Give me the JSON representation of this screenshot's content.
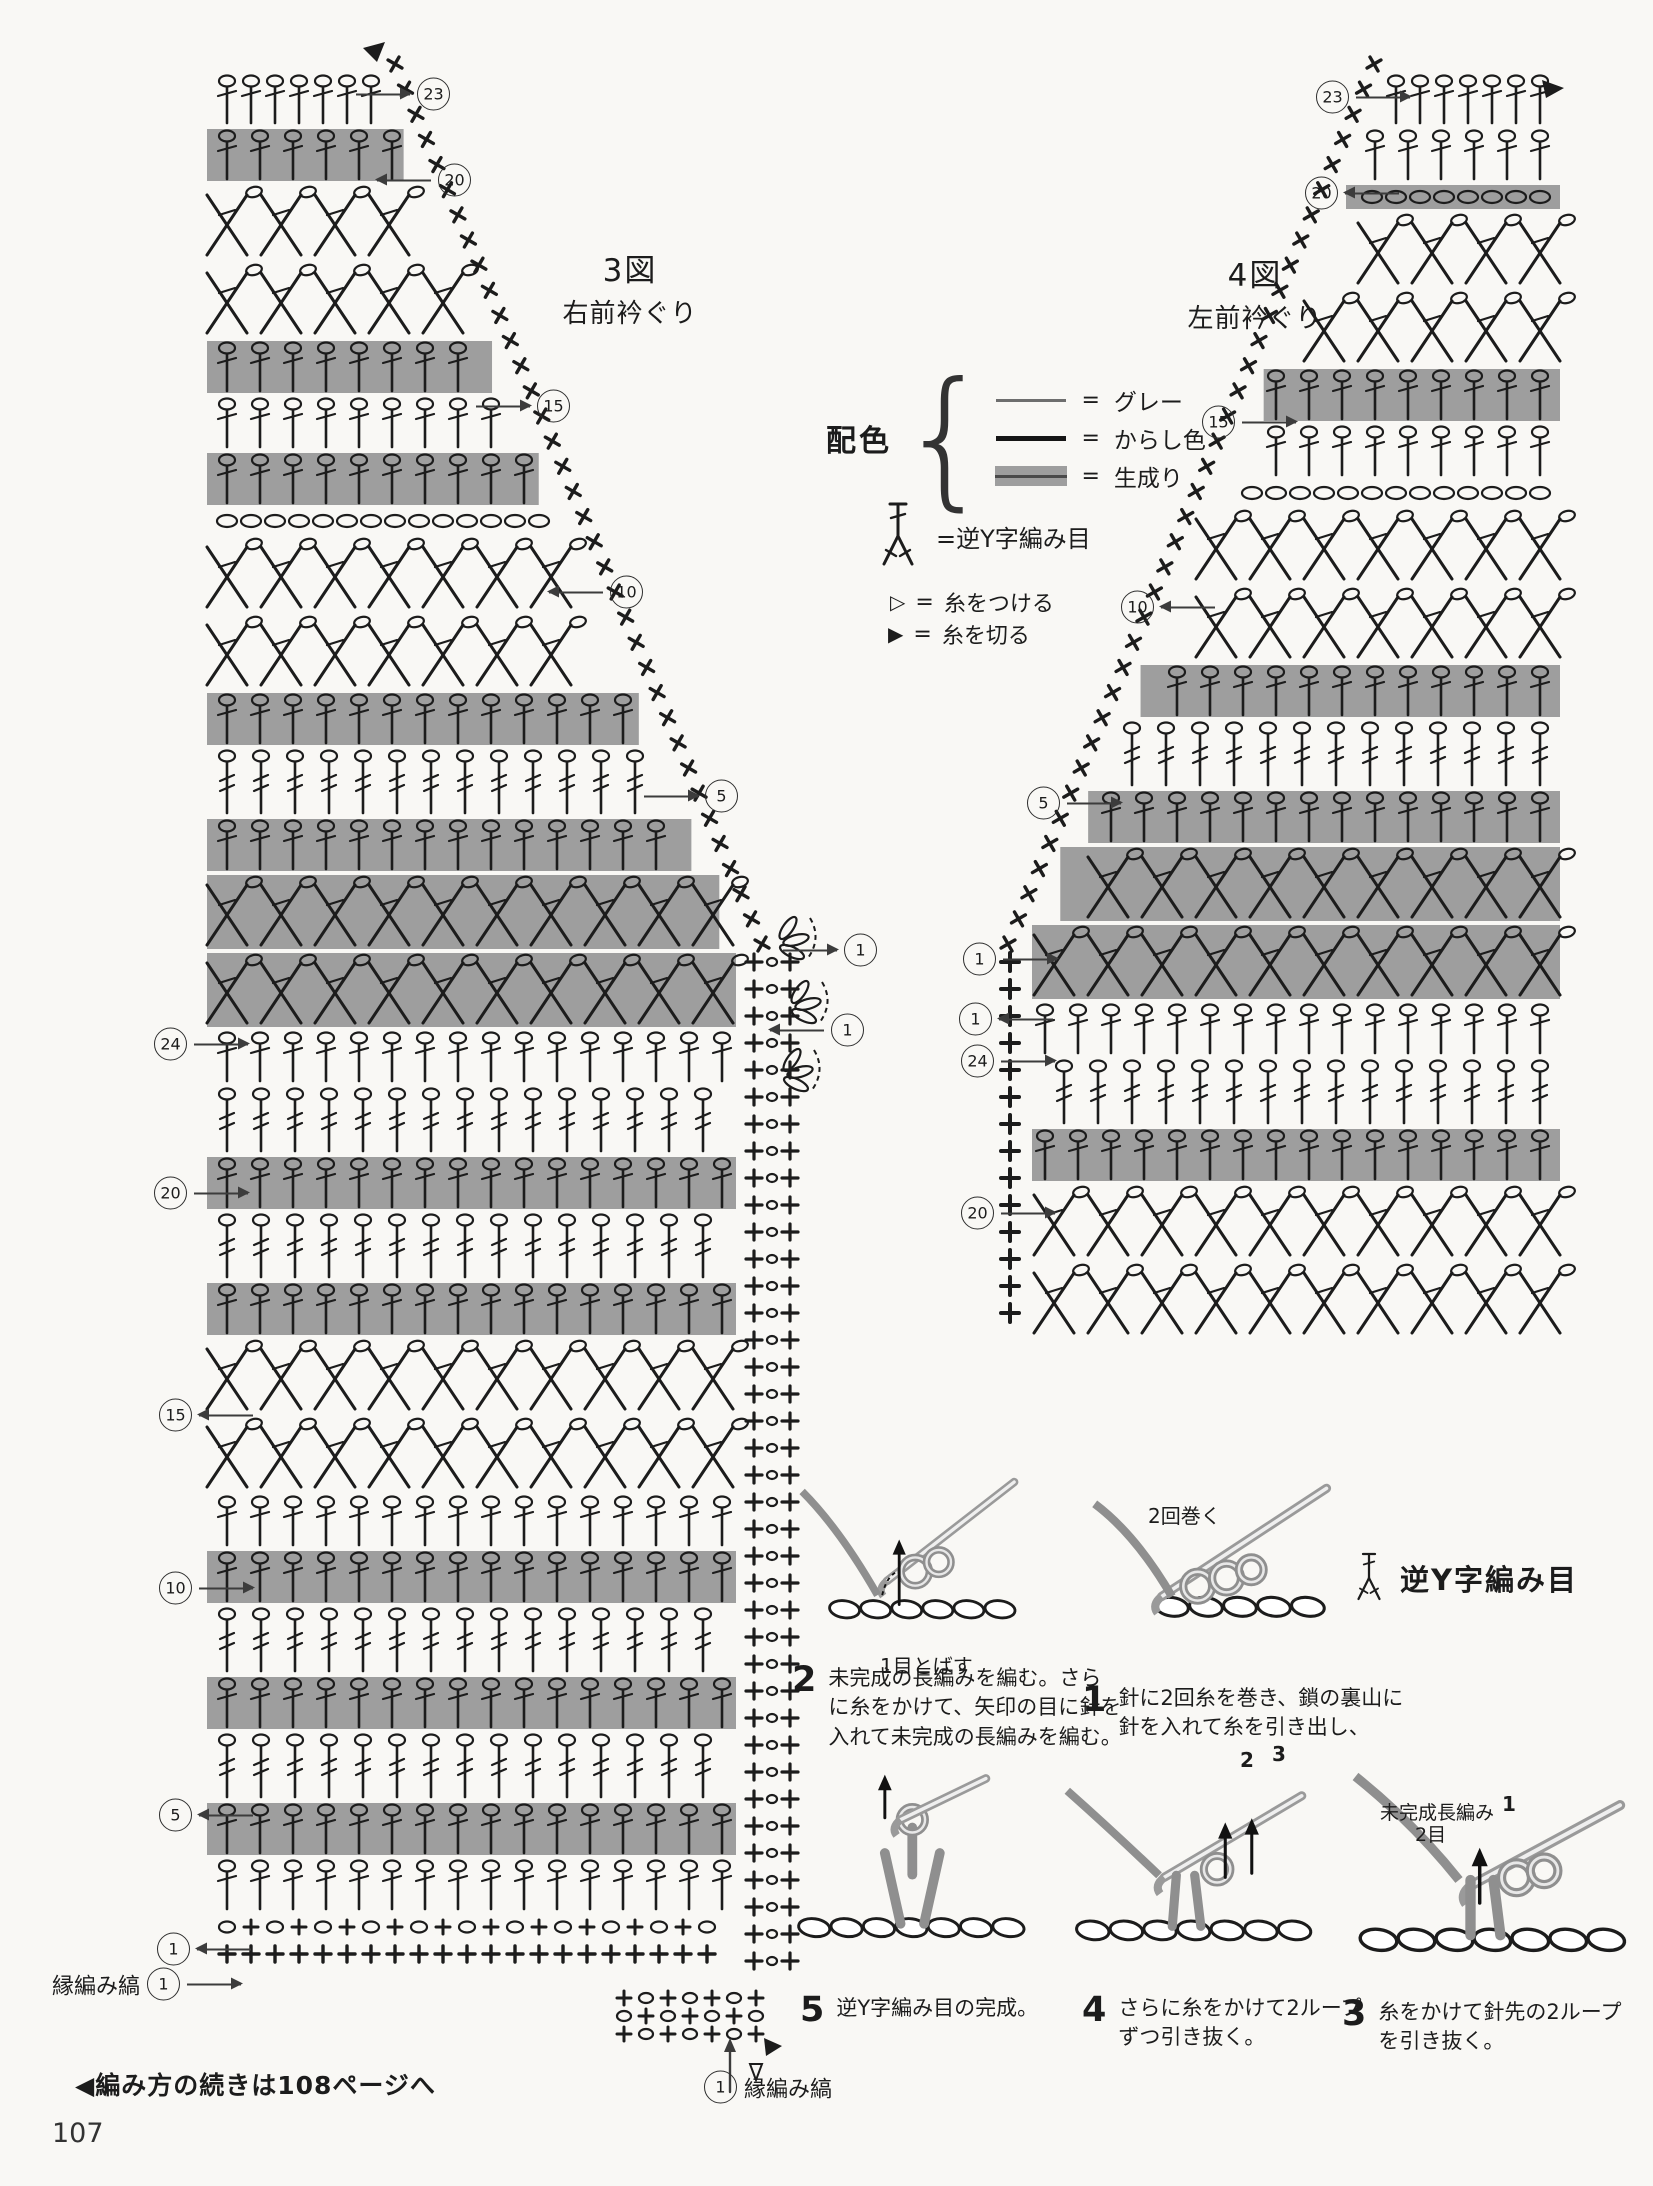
{
  "page": {
    "number": "107",
    "footer_note": "◀編み方の続きは108ページへ"
  },
  "charts": {
    "left": {
      "title": "3図",
      "subtitle": "右前衿ぐり",
      "shape": {
        "side": "right",
        "left": 65,
        "right": 592,
        "top": 32,
        "diag": {
          "x1": 225,
          "y1": 32,
          "x2": 592,
          "y2": 912
        },
        "bottom": 1927
      },
      "rows": [
        {
          "t": "Ttop"
        },
        {
          "t": "T",
          "band": true
        },
        {
          "t": "X"
        },
        {
          "t": "X"
        },
        {
          "t": "T",
          "band": true
        },
        {
          "t": "T"
        },
        {
          "t": "T",
          "band": true
        },
        {
          "t": "O"
        },
        {
          "t": "X"
        },
        {
          "t": "X"
        },
        {
          "t": "T",
          "band": true
        },
        {
          "t": "TT"
        },
        {
          "t": "T",
          "band": true
        },
        {
          "t": "X",
          "band": true
        },
        {
          "t": "X",
          "band": true
        },
        {
          "t": "T"
        },
        {
          "t": "TT"
        },
        {
          "t": "T",
          "band": true
        },
        {
          "t": "TT"
        },
        {
          "t": "T",
          "band": true
        },
        {
          "t": "X"
        },
        {
          "t": "X"
        },
        {
          "t": "T"
        },
        {
          "t": "T",
          "band": true
        },
        {
          "t": "TT"
        },
        {
          "t": "T",
          "band": true
        },
        {
          "t": "TT"
        },
        {
          "t": "T",
          "band": true
        },
        {
          "t": "T"
        },
        {
          "t": "O+"
        },
        {
          "t": "+"
        }
      ]
    },
    "right": {
      "title": "4図",
      "subtitle": "左前衿ぐり",
      "shape": {
        "side": "left",
        "left": 86,
        "right": 612,
        "top": 32,
        "diag": {
          "x1": 452,
          "y1": 32,
          "x2": 86,
          "y2": 912
        },
        "bottom": 1299
      },
      "rows": [
        {
          "t": "Ttop"
        },
        {
          "t": "T"
        },
        {
          "t": "O",
          "band": true
        },
        {
          "t": "X"
        },
        {
          "t": "X"
        },
        {
          "t": "T",
          "band": true
        },
        {
          "t": "T"
        },
        {
          "t": "O"
        },
        {
          "t": "X"
        },
        {
          "t": "X"
        },
        {
          "t": "T",
          "band": true
        },
        {
          "t": "TT"
        },
        {
          "t": "T",
          "band": true
        },
        {
          "t": "X",
          "band": true
        },
        {
          "t": "X",
          "band": true
        },
        {
          "t": "T"
        },
        {
          "t": "TT"
        },
        {
          "t": "T",
          "band": true
        },
        {
          "t": "X"
        },
        {
          "t": "X"
        }
      ]
    }
  },
  "markers": [
    {
      "n": "23",
      "x": 434,
      "y": 94,
      "order": "AC",
      "arrow": "right"
    },
    {
      "n": "20",
      "x": 455,
      "y": 180,
      "order": "AC",
      "arrow": "left"
    },
    {
      "n": "15",
      "x": 554,
      "y": 406,
      "order": "AC",
      "arrow": "right"
    },
    {
      "n": "10",
      "x": 627,
      "y": 592,
      "order": "AC",
      "arrow": "left"
    },
    {
      "n": "5",
      "x": 722,
      "y": 796,
      "order": "AC",
      "arrow": "right"
    },
    {
      "n": "1",
      "x": 861,
      "y": 950,
      "order": "AC",
      "arrow": "right"
    },
    {
      "n": "1",
      "x": 848,
      "y": 1030,
      "order": "AC",
      "arrow": "left"
    },
    {
      "n": "24",
      "x": 170,
      "y": 1044,
      "order": "CA",
      "arrow": "right"
    },
    {
      "n": "20",
      "x": 170,
      "y": 1193,
      "order": "CA",
      "arrow": "right"
    },
    {
      "n": "15",
      "x": 175,
      "y": 1415,
      "order": "CA",
      "arrow": "left"
    },
    {
      "n": "10",
      "x": 175,
      "y": 1588,
      "order": "CA",
      "arrow": "right"
    },
    {
      "n": "5",
      "x": 175,
      "y": 1815,
      "order": "CA",
      "arrow": "left"
    },
    {
      "n": "1",
      "x": 173,
      "y": 1949,
      "order": "CA",
      "arrow": "left"
    },
    {
      "n": "1",
      "x": 171,
      "y": 1984,
      "order": "CA",
      "arrow": "right",
      "pre": "縁編み縞"
    },
    {
      "n": "23",
      "x": 1332,
      "y": 97,
      "order": "CA",
      "arrow": "right"
    },
    {
      "n": "20",
      "x": 1321,
      "y": 193,
      "order": "CA",
      "arrow": "left"
    },
    {
      "n": "15",
      "x": 1218,
      "y": 422,
      "order": "CA",
      "arrow": "right"
    },
    {
      "n": "10",
      "x": 1137,
      "y": 607,
      "order": "CA",
      "arrow": "left"
    },
    {
      "n": "5",
      "x": 1043,
      "y": 803,
      "order": "CA",
      "arrow": "right"
    },
    {
      "n": "1",
      "x": 979,
      "y": 959,
      "order": "CA",
      "arrow": "right"
    },
    {
      "n": "1",
      "x": 975,
      "y": 1019,
      "order": "CA",
      "arrow": "left"
    },
    {
      "n": "24",
      "x": 977,
      "y": 1061,
      "order": "CA",
      "arrow": "right"
    },
    {
      "n": "20",
      "x": 977,
      "y": 1213,
      "order": "CA",
      "arrow": "right"
    },
    {
      "n": "1",
      "x": 720,
      "y": 2087,
      "order": "CA",
      "arrow": null,
      "post": "縁編み縞"
    }
  ],
  "legend": {
    "heading": "配色",
    "items": [
      {
        "swatch": "thin-line",
        "text": "グレー"
      },
      {
        "swatch": "thick-line",
        "text": "からし色"
      },
      {
        "swatch": "gray-band",
        "text": "生成り"
      }
    ],
    "eq": "=",
    "stitch_symbol_label": "=逆Y字編み目",
    "attach_symbol": "▷",
    "attach_label": "糸をつける",
    "cut_symbol": "▶",
    "cut_label": "糸を切る"
  },
  "steps": {
    "heading": "逆Y字編み目",
    "items": [
      {
        "number": "1",
        "text": "針に2回糸を巻き、鎖の裏山に針を入れて糸を引き出し、"
      },
      {
        "number": "2",
        "text": "未完成の長編みを編む。さらに糸をかけて、矢印の目に針を入れて未完成の長編みを編む。"
      },
      {
        "number": "3",
        "text": "糸をかけて針先の2ループを引き抜く。"
      },
      {
        "number": "4",
        "text": "さらに糸をかけて2ループずつ引き抜く。"
      },
      {
        "number": "5",
        "text": "逆Y字編み目の完成。"
      }
    ],
    "labels": {
      "skip_one": "1目とばす",
      "wrap_twice": "2回巻く",
      "two": "2",
      "three": "3",
      "one": "1",
      "unfinished": "未完成長編み",
      "two_sts": "2目"
    }
  },
  "colors": {
    "ink": "#1c1c1c",
    "band": "#9e9e9e",
    "yarn_gray": "#8f8f8f",
    "paper": "#f9f8f5"
  }
}
